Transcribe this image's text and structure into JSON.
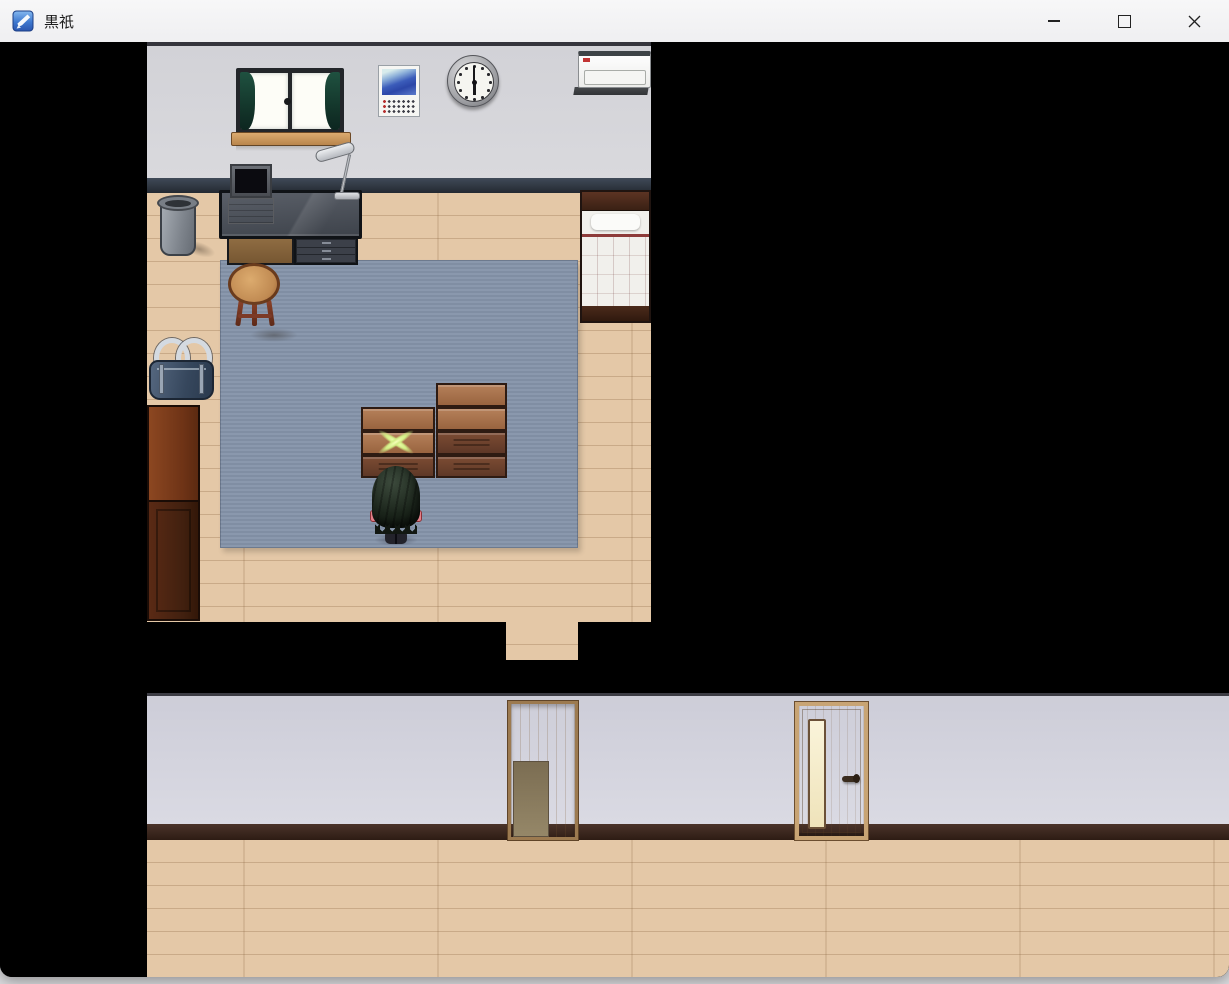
{
  "window": {
    "title": "黒祇",
    "app_icon": "rpg-maker-game-icon",
    "controls": {
      "minimize": "Minimize",
      "maximize": "Maximize",
      "close": "Close"
    }
  },
  "scene": {
    "type": "top-down rpg interior, bedroom above and hallway below, unexplored areas black",
    "clock_time": "6:00",
    "room_objects": [
      "curtained window",
      "photo calendar",
      "wall clock",
      "air conditioner",
      "desk with computer and lamp",
      "trash can",
      "single bed with red blanket",
      "round wooden table",
      "blue rug",
      "two stacks of wooden crates",
      "glowing X marker on crate",
      "navy sports bag",
      "brown wardrobe",
      "player character facing away"
    ],
    "hallway_objects": [
      "open doorway aligned with room exit",
      "closed wooden door with lit window slit and handle"
    ]
  },
  "palette": {
    "titlebar_bg": "#f3f3f4",
    "game_bg": "#000000",
    "wall": "#d6d6da",
    "room_baseboard": "#2b323c",
    "wood_floor": "#e4c8a7",
    "carpet": "#8594aa",
    "hall_baseboard": "#3a261c",
    "crate_light": "#a5754e",
    "crate_dark": "#6d4430",
    "bed_blanket": "#c25a58",
    "sparkle": "#dff29a",
    "door_wood": "#bc9261"
  }
}
